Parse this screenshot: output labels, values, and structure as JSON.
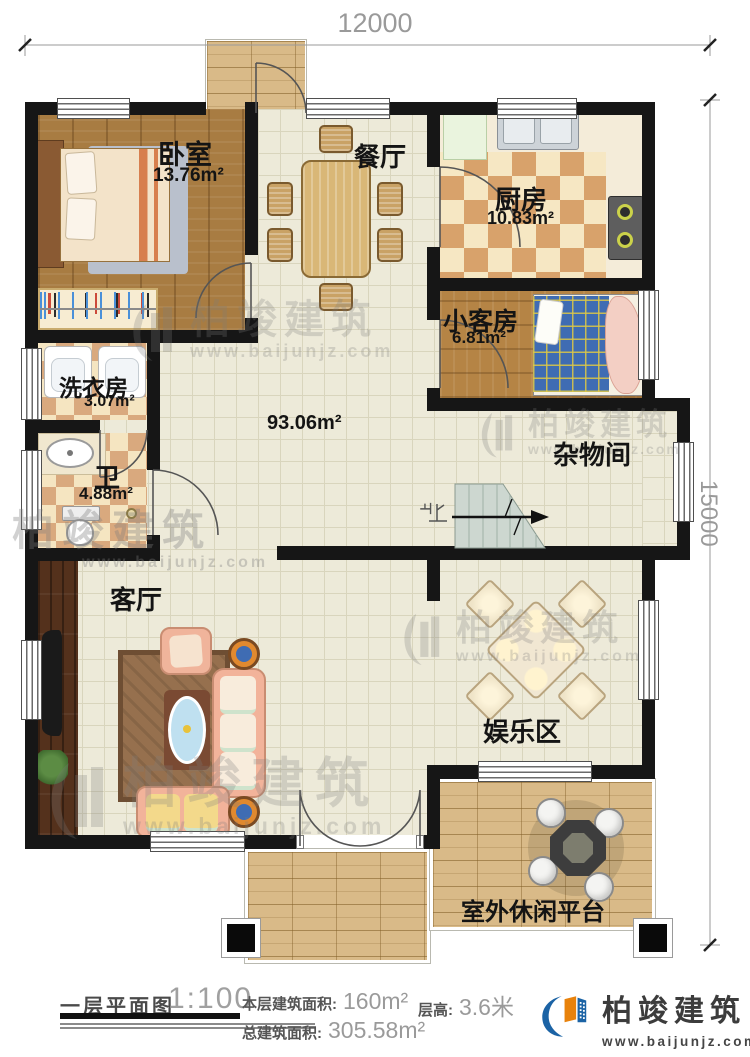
{
  "dimensions": {
    "top": "12000",
    "right": "15000"
  },
  "rooms": [
    {
      "name": "卧室",
      "area": "13.76m²"
    },
    {
      "name": "餐厅",
      "area": ""
    },
    {
      "name": "厨房",
      "area": "10.83m²"
    },
    {
      "name": "小客房",
      "area": "6.81m²"
    },
    {
      "name": "洗衣房",
      "area": "3.07m²"
    },
    {
      "name": "卫",
      "area": "4.88m²"
    },
    {
      "name": "",
      "area": "93.06m²"
    },
    {
      "name": "杂物间",
      "area": ""
    },
    {
      "name": "客厅",
      "area": ""
    },
    {
      "name": "娱乐区",
      "area": ""
    },
    {
      "name": "室外休闲平台",
      "area": ""
    }
  ],
  "stairs": {
    "up_label": "上"
  },
  "footer": {
    "plan_title": "一层平面图",
    "scale": "1:100",
    "floor_area_label": "本层建筑面积:",
    "floor_area_value": "160m²",
    "floor_height_label": "层高:",
    "floor_height_value": "3.6米",
    "total_area_label": "总建筑面积:",
    "total_area_value": "305.58m²"
  },
  "brand": {
    "name": "柏竣建筑",
    "site": "www.baijunjz.com"
  },
  "watermark": {
    "name": "柏竣建筑",
    "site": "www.baijunjz.com"
  },
  "colors": {
    "wall": "#161616",
    "floor_tile": "#edead9",
    "tile_grid": "#d9d5bd",
    "wood": "#a87c42",
    "wood_dark": "#54311c",
    "checker_tan": "#d8a26b",
    "checker_cream": "#f6e7c3",
    "paver": "#d9ba88",
    "brand_blue": "#1b63a5",
    "brand_orange": "#e8820c",
    "label_text": "#141414",
    "dim_text": "#9a9a9a"
  }
}
